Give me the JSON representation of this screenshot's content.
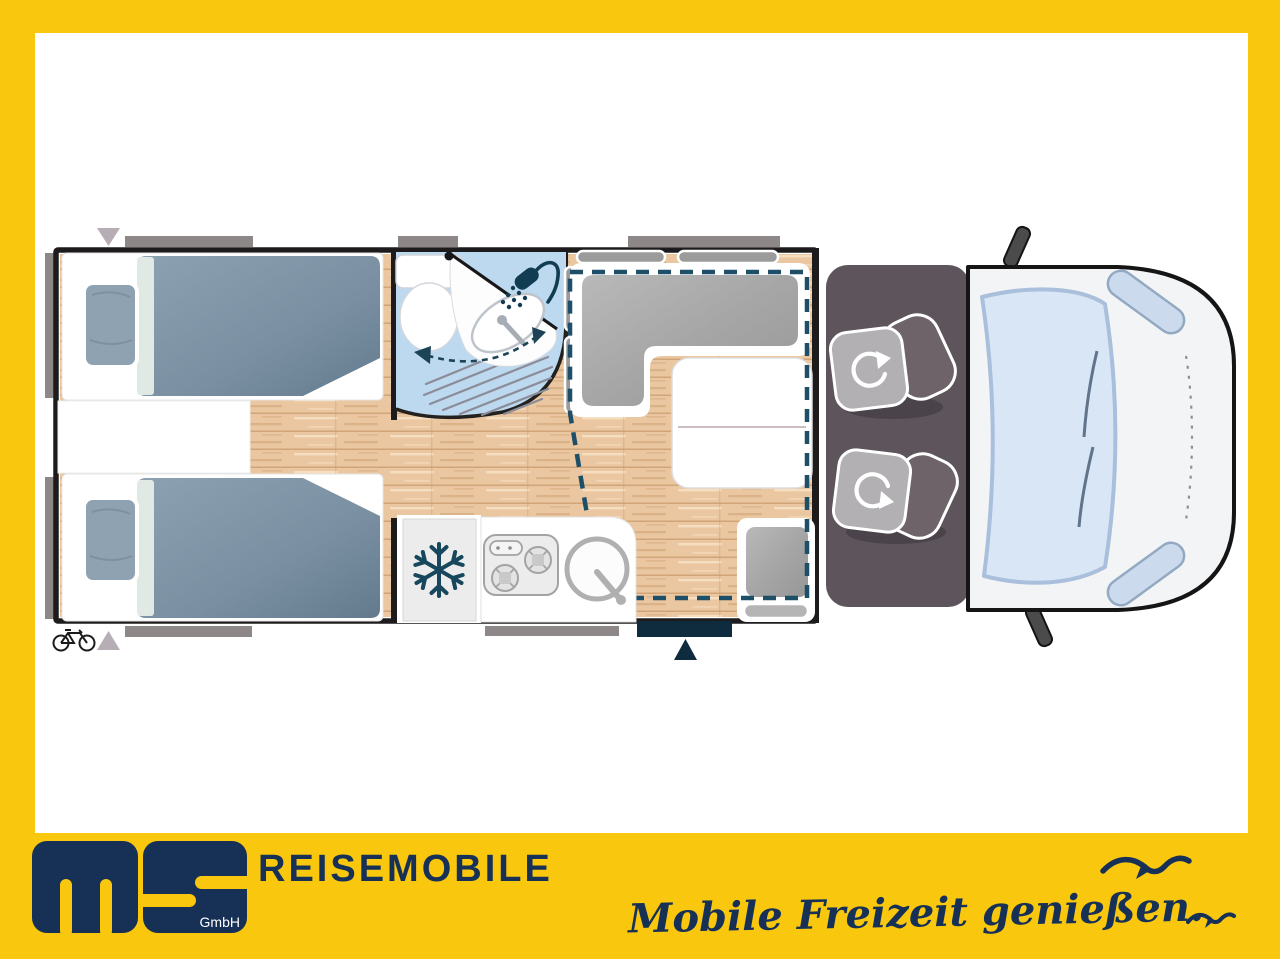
{
  "branding": {
    "company_wordmark": "REISEMOBILE",
    "logo_letters": "ms",
    "logo_suffix": "GmbH",
    "tagline": "Mobile Freizeit genießen."
  },
  "colors": {
    "frame_yellow": "#F8C70E",
    "brand_navy": "#163056",
    "plan_dash_teal": "#1E4F68",
    "wall_black": "#1D1B1B",
    "wood_floor": "#EAC7A0",
    "bath_blue": "#BCD9EF",
    "mattress_blue": "#7D93A5",
    "cushion_gray": "#A6A6A6",
    "cab_dark": "#5D555B",
    "windshield_blue": "#D9E6F6",
    "door_navy": "#0F2B3E",
    "window_gray": "#8D8787"
  },
  "plan_icons": {
    "snowflake_icon": "fridge / freezer compartment",
    "shower_icon": "shower head in bathroom",
    "toilet_icon": "toilet",
    "washbasin_icon": "swivel washbasin",
    "hob_icon": "two burner kitchen hob",
    "sink_icon": "round kitchen sink",
    "bicycle_icon": "rear bike storage",
    "swivel_seat_icon": "rotating cab seat arrow",
    "entrance_arrow_icon": "entrance door marker",
    "drop_down_bed_outline": "dashed pull-down bed over dinette",
    "seagull_icon": "brand seagull silhouettes"
  }
}
